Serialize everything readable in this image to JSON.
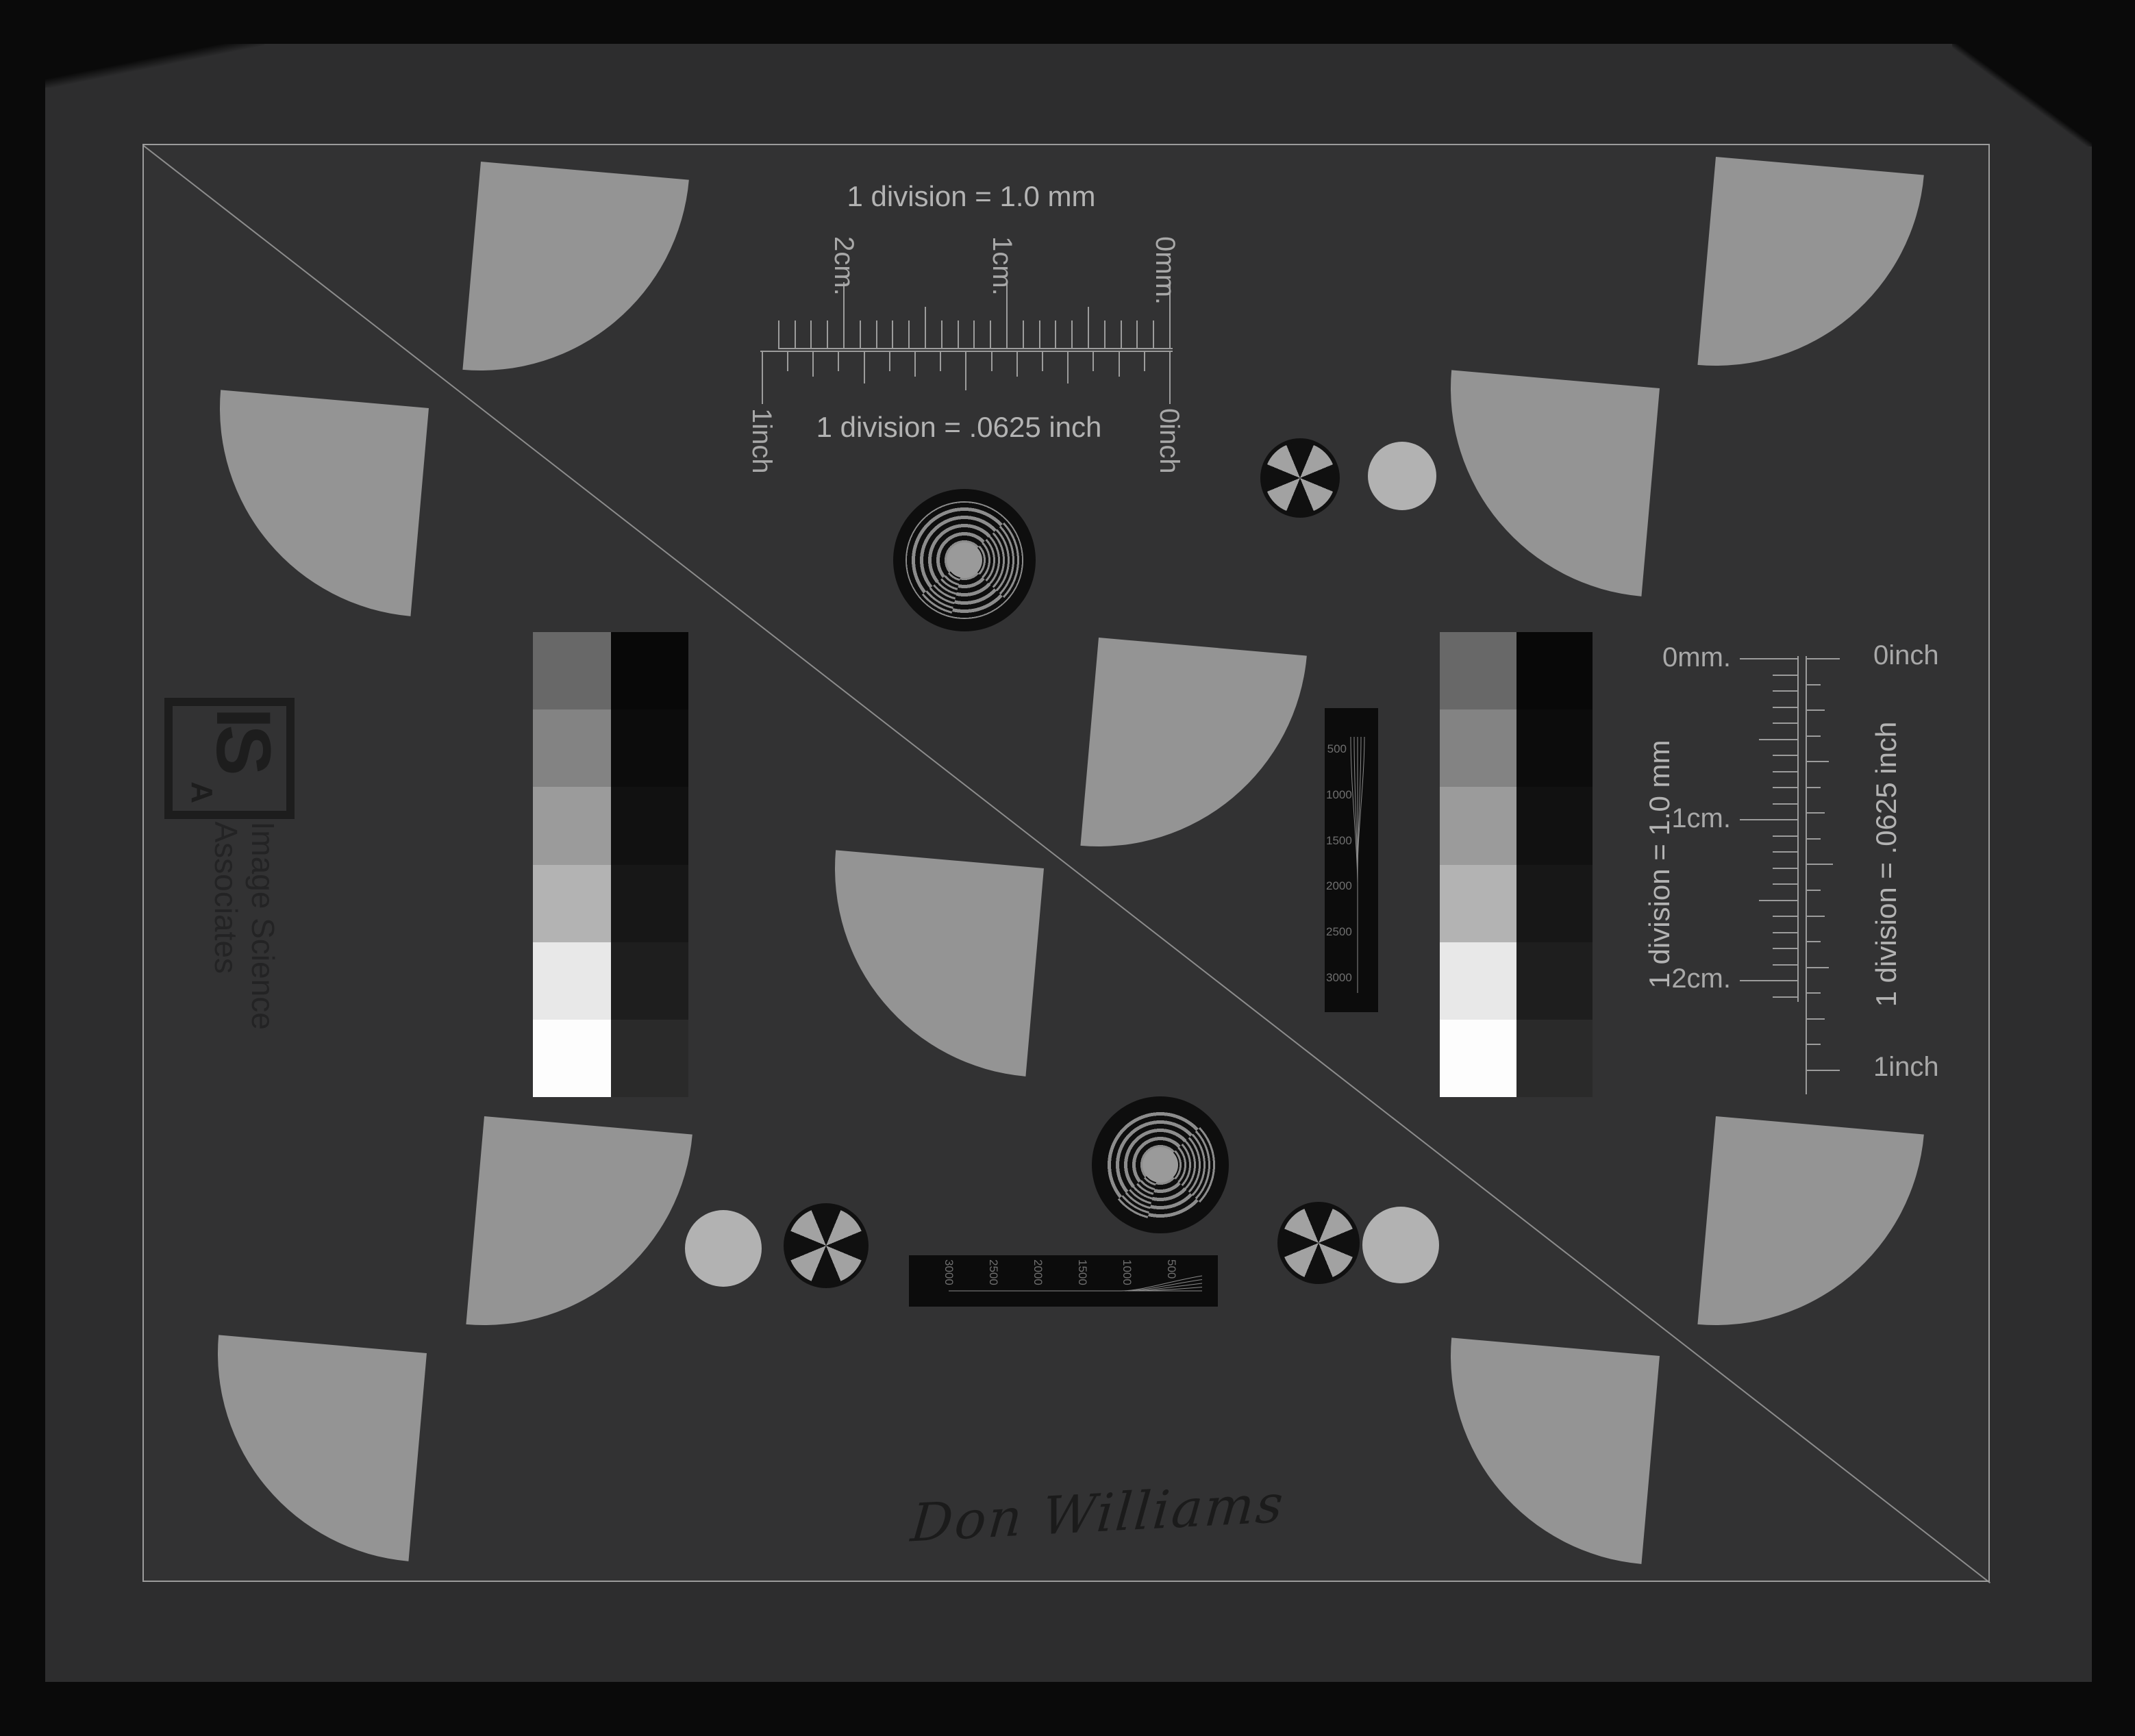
{
  "page": {
    "signature": "Don Williams"
  },
  "logo": {
    "initials_main": "IS",
    "initials_sub": "A",
    "name_line1": "Image Science",
    "name_line2": "Associates"
  },
  "rulers": {
    "top_mm": {
      "caption": "1 division = 1.0 mm",
      "label_2cm": "2cm.",
      "label_1cm": "1cm.",
      "label_0mm": "0mm."
    },
    "top_inch": {
      "caption": "1 division = .0625 inch",
      "label_1inch": "1inch",
      "label_0inch": "0inch"
    },
    "right_mm": {
      "caption": "1 division = 1.0 mm",
      "label_0mm": "0mm.",
      "label_1cm": "1cm.",
      "label_2cm": "2cm."
    },
    "right_inch": {
      "caption": "1 division = .0625 inch",
      "label_0inch": "0inch",
      "label_1inch": "1inch"
    }
  },
  "resolution_wedges": {
    "vertical_labels": [
      "500",
      "1000",
      "1500",
      "2000",
      "2500",
      "3000"
    ],
    "horizontal_labels": [
      "3000",
      "2500",
      "2000",
      "1500",
      "1000",
      "500"
    ]
  },
  "step_wedge": {
    "light_column": [
      "#686868",
      "#838383",
      "#9b9b9b",
      "#b3b3b3",
      "#e8e8e8",
      "#fdfdfd"
    ],
    "dark_column": [
      "#080808",
      "#0c0c0c",
      "#111111",
      "#171717",
      "#1e1e1e",
      "#2a2a2a"
    ]
  },
  "colors": {
    "background": "#0a0a0a",
    "paper": "#2d2d2e",
    "inner": "#323233",
    "line": "#9c9c9c",
    "text_light": "#b3b3b3",
    "text_mid": "#a8a8a8",
    "text_dark": "#1d1d1d",
    "fan": "#949494",
    "circle": "#b2b2b2",
    "propeller_gray": "#a2a2a2",
    "target_ring": "#8c8c8c",
    "bar_background": "#0c0c0c",
    "bar_text": "#6f6f6f"
  }
}
